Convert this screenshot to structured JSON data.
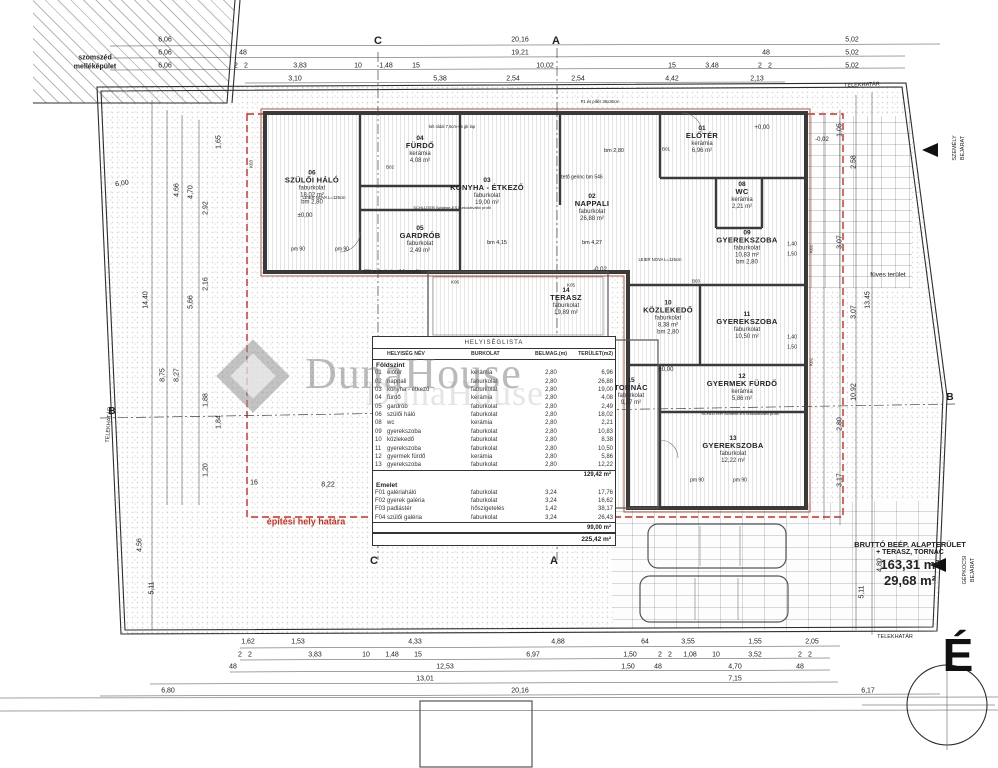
{
  "plan_title": "HELYISÉGLISTA",
  "watermark": {
    "text": "DunaHouse",
    "echo": "DunaHouse"
  },
  "north": {
    "letter": "É"
  },
  "colors": {
    "red_accent": "#cf2b1d",
    "wall": "#3a3a3a",
    "wall_red": "#b3543f"
  },
  "brutto": {
    "line1": "BRUTTÓ BEÉP. ALAPTERÜLET",
    "line2": "+ TERASZ, TORNÁC",
    "area1": "163,31 m²",
    "area2": "29,68 m²"
  },
  "table": {
    "title": "HELYISÉGLISTA",
    "columns": [
      "",
      "HELYISÉG NÉV",
      "BURKOLAT",
      "BELMAG.(m)",
      "TERÜLET(m2)"
    ],
    "sections": [
      {
        "name": "Földszint",
        "rows": [
          [
            "01",
            "előtér",
            "kerámia",
            "2,80",
            "6,96"
          ],
          [
            "02",
            "nappali",
            "faburkolat",
            "2,80",
            "26,88"
          ],
          [
            "03",
            "konyha - étkező",
            "faburkolat",
            "2,80",
            "19,00"
          ],
          [
            "04",
            "fürdő",
            "kerámia",
            "2,80",
            "4,08"
          ],
          [
            "05",
            "gardrób",
            "faburkolat",
            "2,80",
            "2,49"
          ],
          [
            "06",
            "szülői háló",
            "faburkolat",
            "2,80",
            "18,02"
          ],
          [
            "08",
            "wc",
            "kerámia",
            "2,80",
            "2,21"
          ],
          [
            "09",
            "gyerekszoba",
            "faburkolat",
            "2,80",
            "10,83"
          ],
          [
            "10",
            "közlekedő",
            "faburkolat",
            "2,80",
            "8,38"
          ],
          [
            "11",
            "gyerekszoba",
            "faburkolat",
            "2,80",
            "10,50"
          ],
          [
            "12",
            "gyermek fürdő",
            "kerámia",
            "2,80",
            "5,86"
          ],
          [
            "13",
            "gyerekszoba",
            "faburkolat",
            "2,80",
            "12,22"
          ]
        ],
        "subtotal": "129,42 m²"
      },
      {
        "name": "Emelet",
        "rows": [
          [
            "F01",
            "galériaháló",
            "faburkolat",
            "3,24",
            "17,76"
          ],
          [
            "F02",
            "gyerek galéria",
            "faburkolat",
            "3,24",
            "16,62"
          ],
          [
            "F03",
            "padlástér",
            "hőszigetelés",
            "1,42",
            "38,17"
          ],
          [
            "F04",
            "szülői galéria",
            "faburkolat",
            "3,24",
            "26,43"
          ]
        ],
        "subtotal": "99,00 m²"
      }
    ],
    "total": "225,42 m²"
  },
  "rooms": [
    {
      "num": "06",
      "name": "SZÜLŐI HÁLÓ",
      "finish": "faburkolat",
      "area": "18,02 m²",
      "extra": "bm 2,80",
      "x": 312,
      "y": 188
    },
    {
      "num": "04",
      "name": "FÜRDŐ",
      "finish": "kerámia",
      "area": "4,08 m²",
      "x": 420,
      "y": 150
    },
    {
      "num": "05",
      "name": "GARDRÓB",
      "finish": "faburkolat",
      "area": "2,49 m²",
      "x": 420,
      "y": 240
    },
    {
      "num": "03",
      "name": "KONYHA - ÉTKEZŐ",
      "finish": "faburkolat",
      "area": "19,00 m²",
      "x": 487,
      "y": 192
    },
    {
      "num": "02",
      "name": "NAPPALI",
      "finish": "faburkolat",
      "area": "26,88 m²",
      "x": 592,
      "y": 208
    },
    {
      "num": "01",
      "name": "ELŐTÉR",
      "finish": "kerámia",
      "area": "6,96 m²",
      "x": 702,
      "y": 140
    },
    {
      "num": "08",
      "name": "WC",
      "finish": "kerámia",
      "area": "2,21 m²",
      "x": 742,
      "y": 196
    },
    {
      "num": "09",
      "name": "GYEREKSZOBA",
      "finish": "faburkolat",
      "area": "10,83 m²",
      "extra": "bm 2,80",
      "x": 747,
      "y": 248
    },
    {
      "num": "11",
      "name": "GYEREKSZOBA",
      "finish": "faburkolat",
      "area": "10,50 m²",
      "x": 747,
      "y": 326
    },
    {
      "num": "10",
      "name": "KÖZLEKEDŐ",
      "finish": "faburkolat",
      "area": "8,38 m²",
      "extra": "bm 2,80",
      "x": 668,
      "y": 318
    },
    {
      "num": "14",
      "name": "TERASZ",
      "finish": "faburkolat",
      "area": "19,89 m²",
      "x": 566,
      "y": 302
    },
    {
      "num": "15",
      "name": "TORNÁC",
      "finish": "faburkolat",
      "area": "9,37 m²",
      "x": 631,
      "y": 392
    },
    {
      "num": "12",
      "name": "GYERMEK FÜRDŐ",
      "finish": "kerámia",
      "area": "5,86 m²",
      "x": 742,
      "y": 388
    },
    {
      "num": "13",
      "name": "GYEREKSZOBA",
      "finish": "faburkolat",
      "area": "12,22 m²",
      "x": 733,
      "y": 450
    }
  ],
  "annotations": [
    {
      "t": "szomszéd",
      "x": 95,
      "y": 58,
      "s": 7,
      "b": 1
    },
    {
      "t": "melléképület",
      "x": 95,
      "y": 67,
      "s": 7,
      "b": 1
    },
    {
      "t": "TELEKHATÁR",
      "x": 862,
      "y": 86,
      "s": 5.5,
      "r": -2
    },
    {
      "t": "TELEKHATÁR",
      "x": 895,
      "y": 638,
      "s": 5.5
    },
    {
      "t": "TELEKHATÁR",
      "x": 110,
      "y": 425,
      "s": 5.5,
      "r": -86
    },
    {
      "t": "füves terület",
      "x": 888,
      "y": 276,
      "s": 6.5
    },
    {
      "t": "építési hely határa",
      "x": 306,
      "y": 522,
      "s": 9,
      "b": 1,
      "c": "#cf2b1d"
    },
    {
      "t": "SZEMÉLY",
      "x": 956,
      "y": 148,
      "s": 5.5,
      "r": -90
    },
    {
      "t": "BEJÁRAT",
      "x": 964,
      "y": 148,
      "s": 5.5,
      "r": -90
    },
    {
      "t": "GÉPKOCSI",
      "x": 966,
      "y": 570,
      "s": 5.5,
      "r": -90
    },
    {
      "t": "BEJÁRAT",
      "x": 974,
      "y": 570,
      "s": 5.5,
      "r": -90
    },
    {
      "t": "C",
      "x": 378,
      "y": 42,
      "s": 11,
      "b": 1
    },
    {
      "t": "A",
      "x": 556,
      "y": 42,
      "s": 11,
      "b": 1
    },
    {
      "t": "C",
      "x": 374,
      "y": 562,
      "s": 11,
      "b": 1
    },
    {
      "t": "A",
      "x": 554,
      "y": 562,
      "s": 11,
      "b": 1
    },
    {
      "t": "B",
      "x": 112,
      "y": 412,
      "s": 10,
      "b": 1
    },
    {
      "t": "B",
      "x": 950,
      "y": 398,
      "s": 10,
      "b": 1
    },
    {
      "t": "±0,00",
      "x": 305,
      "y": 216,
      "s": 6
    },
    {
      "t": "+0,00",
      "x": 762,
      "y": 128,
      "s": 6
    },
    {
      "t": "-0,02",
      "x": 822,
      "y": 140,
      "s": 6
    },
    {
      "t": "-0,02",
      "x": 600,
      "y": 270,
      "s": 6
    },
    {
      "t": "±0,00",
      "x": 666,
      "y": 370,
      "s": 6
    },
    {
      "t": "bm 2,80",
      "x": 614,
      "y": 152,
      "s": 5.5
    },
    {
      "t": "tető gerinc bm 546",
      "x": 582,
      "y": 178,
      "s": 5
    },
    {
      "t": "bm 4,15",
      "x": 497,
      "y": 244,
      "s": 5.5
    },
    {
      "t": "bm 4,27",
      "x": 592,
      "y": 244,
      "s": 5.5
    },
    {
      "t": "pm 90",
      "x": 298,
      "y": 250,
      "s": 5
    },
    {
      "t": "pm 90",
      "x": 342,
      "y": 250,
      "s": 5
    },
    {
      "t": "pm 90",
      "x": 697,
      "y": 481,
      "s": 5
    },
    {
      "t": "pm 90",
      "x": 740,
      "y": 481,
      "s": 5
    },
    {
      "t": "LEIER NOVA L=125cm",
      "x": 324,
      "y": 198,
      "s": 4.2
    },
    {
      "t": "LEIER NOVA L=125cm",
      "x": 660,
      "y": 260,
      "s": 4.2
    },
    {
      "t": "SCHLÜTER Schiene-ES burkolatváltó profil",
      "x": 452,
      "y": 208,
      "s": 4
    },
    {
      "t": "SCHLÜTER Schiene-ES burkolatváltó profil",
      "x": 740,
      "y": 414,
      "s": 4
    },
    {
      "t": "két oldal 7,5cm-es gk lap",
      "x": 452,
      "y": 127,
      "s": 4.2
    },
    {
      "t": "P1 és pillér 36x36cm",
      "x": 600,
      "y": 102,
      "s": 4.2
    },
    {
      "t": "Ø32 andezit zúzottkő szegély",
      "x": 392,
      "y": 272,
      "s": 4.4
    },
    {
      "t": "K03",
      "x": 252,
      "y": 164,
      "s": 4.5,
      "r": -90
    },
    {
      "t": "K02",
      "x": 812,
      "y": 249,
      "s": 4.5,
      "r": -90
    },
    {
      "t": "K02",
      "x": 812,
      "y": 362,
      "s": 4.5,
      "r": -90
    },
    {
      "t": "K06",
      "x": 455,
      "y": 283,
      "s": 4.5
    },
    {
      "t": "K05",
      "x": 571,
      "y": 286,
      "s": 4.5
    },
    {
      "t": "B01",
      "x": 666,
      "y": 150,
      "s": 4.5
    },
    {
      "t": "B02",
      "x": 390,
      "y": 168,
      "s": 4.5
    },
    {
      "t": "B03",
      "x": 696,
      "y": 282,
      "s": 4.5
    },
    {
      "t": "1,40",
      "x": 792,
      "y": 245,
      "s": 5
    },
    {
      "t": "1,50",
      "x": 792,
      "y": 255,
      "s": 5
    },
    {
      "t": "1,40",
      "x": 792,
      "y": 338,
      "s": 5
    },
    {
      "t": "1,50",
      "x": 792,
      "y": 348,
      "s": 5
    }
  ],
  "dims": [
    {
      "t": "6,06",
      "x": 165,
      "y": 40
    },
    {
      "t": "20,16",
      "x": 520,
      "y": 40
    },
    {
      "t": "5,02",
      "x": 852,
      "y": 40
    },
    {
      "t": "6,06",
      "x": 165,
      "y": 53
    },
    {
      "t": "48",
      "x": 243,
      "y": 53
    },
    {
      "t": "19,21",
      "x": 520,
      "y": 53
    },
    {
      "t": "48",
      "x": 766,
      "y": 53
    },
    {
      "t": "5,02",
      "x": 852,
      "y": 53
    },
    {
      "t": "6,06",
      "x": 165,
      "y": 66
    },
    {
      "t": "2",
      "x": 236,
      "y": 66
    },
    {
      "t": "2",
      "x": 246,
      "y": 66
    },
    {
      "t": "3,83",
      "x": 300,
      "y": 66
    },
    {
      "t": "10",
      "x": 358,
      "y": 66
    },
    {
      "t": "1,48",
      "x": 386,
      "y": 66
    },
    {
      "t": "15",
      "x": 416,
      "y": 66
    },
    {
      "t": "10,02",
      "x": 545,
      "y": 66
    },
    {
      "t": "15",
      "x": 672,
      "y": 66
    },
    {
      "t": "3,48",
      "x": 712,
      "y": 66
    },
    {
      "t": "2",
      "x": 760,
      "y": 66
    },
    {
      "t": "2",
      "x": 770,
      "y": 66
    },
    {
      "t": "5,02",
      "x": 852,
      "y": 66
    },
    {
      "t": "3,10",
      "x": 295,
      "y": 79
    },
    {
      "t": "5,38",
      "x": 440,
      "y": 79
    },
    {
      "t": "2,54",
      "x": 513,
      "y": 79
    },
    {
      "t": "2,54",
      "x": 578,
      "y": 79
    },
    {
      "t": "4,42",
      "x": 672,
      "y": 79
    },
    {
      "t": "2,13",
      "x": 757,
      "y": 79
    },
    {
      "t": "14,40",
      "x": 146,
      "y": 300,
      "r": -90
    },
    {
      "t": "8,75",
      "x": 163,
      "y": 375,
      "r": -90
    },
    {
      "t": "8,27",
      "x": 177,
      "y": 375,
      "r": -90
    },
    {
      "t": "4,66",
      "x": 177,
      "y": 190,
      "r": -90
    },
    {
      "t": "4,70",
      "x": 191,
      "y": 192,
      "r": -90
    },
    {
      "t": "2,92",
      "x": 206,
      "y": 208,
      "r": -90
    },
    {
      "t": "1,65",
      "x": 219,
      "y": 142,
      "r": -90
    },
    {
      "t": "2,16",
      "x": 206,
      "y": 284,
      "r": -90
    },
    {
      "t": "5,66",
      "x": 191,
      "y": 302,
      "r": -90
    },
    {
      "t": "1,88",
      "x": 206,
      "y": 400,
      "r": -90
    },
    {
      "t": "1,84",
      "x": 219,
      "y": 422,
      "r": -90
    },
    {
      "t": "1,20",
      "x": 206,
      "y": 470,
      "r": -90
    },
    {
      "t": "6,00",
      "x": 122,
      "y": 184,
      "r": -8
    },
    {
      "t": "5,11",
      "x": 152,
      "y": 588,
      "r": -90
    },
    {
      "t": "4,56",
      "x": 140,
      "y": 545,
      "r": -90
    },
    {
      "t": "16",
      "x": 254,
      "y": 483
    },
    {
      "t": "8,22",
      "x": 328,
      "y": 485
    },
    {
      "t": "1,05",
      "x": 840,
      "y": 130,
      "r": -90
    },
    {
      "t": "2,58",
      "x": 854,
      "y": 162,
      "r": -90
    },
    {
      "t": "3,07",
      "x": 840,
      "y": 242,
      "r": -90
    },
    {
      "t": "3,07",
      "x": 854,
      "y": 312,
      "r": -90
    },
    {
      "t": "13,45",
      "x": 868,
      "y": 300,
      "r": -90
    },
    {
      "t": "10,92",
      "x": 854,
      "y": 392,
      "r": -90
    },
    {
      "t": "2,80",
      "x": 840,
      "y": 424,
      "r": -90
    },
    {
      "t": "3,17",
      "x": 840,
      "y": 480,
      "r": -90
    },
    {
      "t": "5,11",
      "x": 862,
      "y": 592,
      "r": -90
    },
    {
      "t": "4,80",
      "x": 880,
      "y": 565,
      "r": -90
    },
    {
      "t": "1,62",
      "x": 248,
      "y": 642
    },
    {
      "t": "1,53",
      "x": 298,
      "y": 642
    },
    {
      "t": "4,33",
      "x": 415,
      "y": 642
    },
    {
      "t": "4,88",
      "x": 558,
      "y": 642
    },
    {
      "t": "64",
      "x": 645,
      "y": 642
    },
    {
      "t": "3,55",
      "x": 688,
      "y": 642
    },
    {
      "t": "1,55",
      "x": 755,
      "y": 642
    },
    {
      "t": "2,05",
      "x": 812,
      "y": 642
    },
    {
      "t": "2",
      "x": 240,
      "y": 655
    },
    {
      "t": "2",
      "x": 250,
      "y": 655
    },
    {
      "t": "3,83",
      "x": 315,
      "y": 655
    },
    {
      "t": "10",
      "x": 366,
      "y": 655
    },
    {
      "t": "1,48",
      "x": 392,
      "y": 655
    },
    {
      "t": "15",
      "x": 418,
      "y": 655
    },
    {
      "t": "6,97",
      "x": 533,
      "y": 655
    },
    {
      "t": "1,50",
      "x": 630,
      "y": 655
    },
    {
      "t": "2",
      "x": 660,
      "y": 655
    },
    {
      "t": "2",
      "x": 670,
      "y": 655
    },
    {
      "t": "1,08",
      "x": 690,
      "y": 655
    },
    {
      "t": "10",
      "x": 716,
      "y": 655
    },
    {
      "t": "3,52",
      "x": 755,
      "y": 655
    },
    {
      "t": "2",
      "x": 800,
      "y": 655
    },
    {
      "t": "2",
      "x": 810,
      "y": 655
    },
    {
      "t": "48",
      "x": 233,
      "y": 667
    },
    {
      "t": "12,53",
      "x": 445,
      "y": 667
    },
    {
      "t": "1,50",
      "x": 628,
      "y": 667
    },
    {
      "t": "48",
      "x": 658,
      "y": 667
    },
    {
      "t": "4,70",
      "x": 735,
      "y": 667
    },
    {
      "t": "48",
      "x": 800,
      "y": 667
    },
    {
      "t": "13,01",
      "x": 425,
      "y": 679
    },
    {
      "t": "7,15",
      "x": 735,
      "y": 679
    },
    {
      "t": "6,80",
      "x": 168,
      "y": 691
    },
    {
      "t": "20,16",
      "x": 520,
      "y": 691
    },
    {
      "t": "6,17",
      "x": 868,
      "y": 691
    }
  ]
}
